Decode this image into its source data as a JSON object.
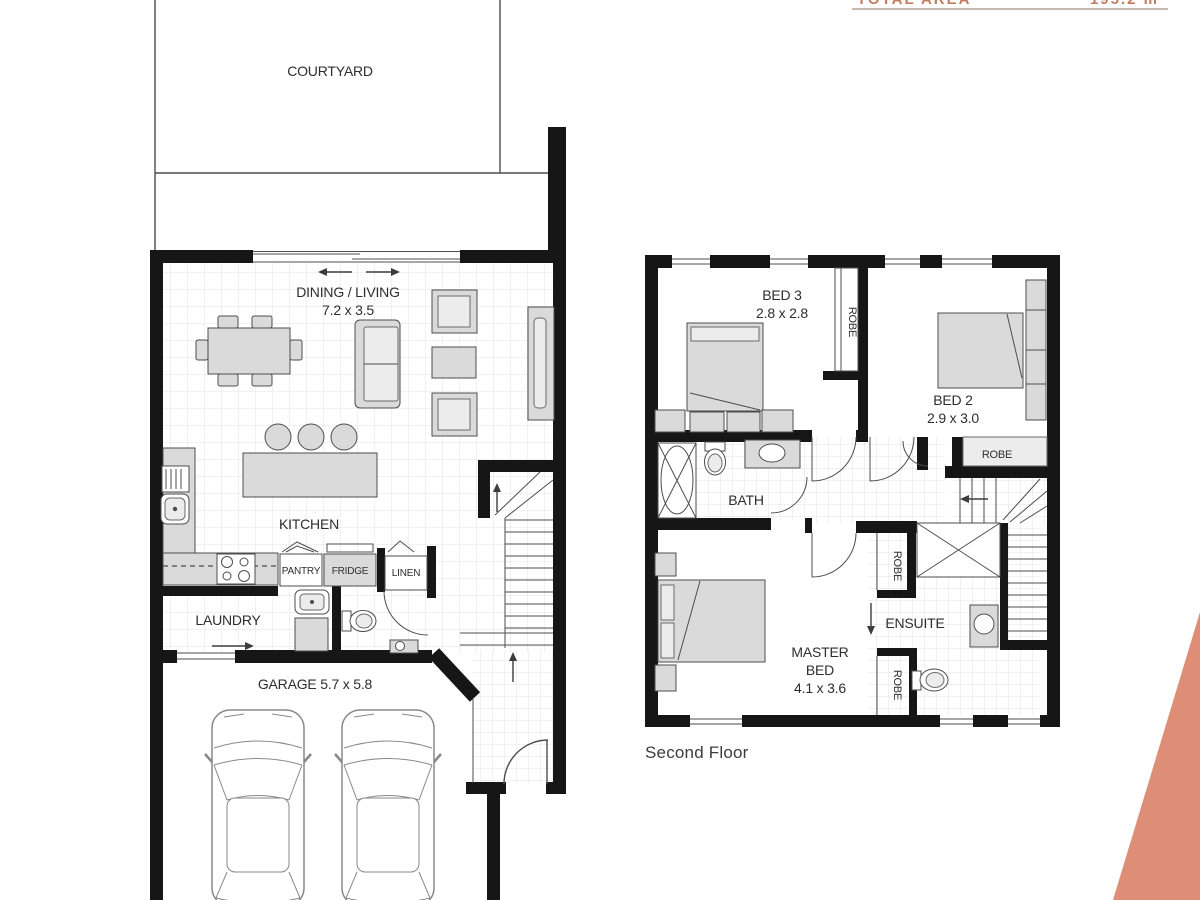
{
  "header": {
    "total_area_label": "TOTAL AREA",
    "total_area_value": "195.2 m²"
  },
  "accent_color": "#DE8D77",
  "ground_floor": {
    "courtyard": "COURTYARD",
    "dining_living": "DINING / LIVING",
    "dining_living_dims": "7.2 x 3.5",
    "kitchen": "KITCHEN",
    "pantry": "PANTRY",
    "fridge": "FRIDGE",
    "linen": "LINEN",
    "laundry": "LAUNDRY",
    "garage": "GARAGE 5.7 x 5.8"
  },
  "second_floor": {
    "label": "Second Floor",
    "bed3": "BED 3",
    "bed3_dims": "2.8 x 2.8",
    "bed2": "BED 2",
    "bed2_dims": "2.9 x 3.0",
    "bath": "BATH",
    "ensuite": "ENSUITE",
    "robe": "ROBE",
    "master_line1": "MASTER",
    "master_line2": "BED",
    "master_dims": "4.1 x 3.6"
  }
}
